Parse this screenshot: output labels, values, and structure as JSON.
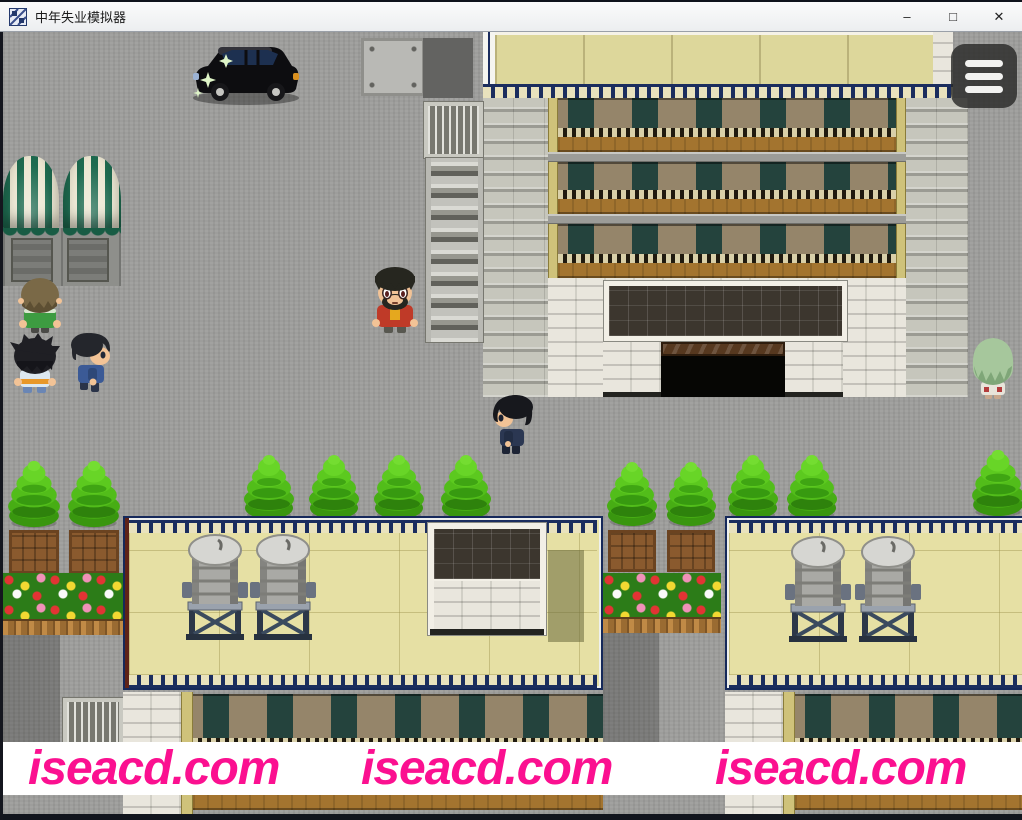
{
  "window": {
    "title": "中年失业模拟器",
    "app_icon": "rpg-maker-window-icon",
    "controls": {
      "minimize": "–",
      "maximize": "□",
      "close": "✕"
    }
  },
  "game": {
    "menu_button": {
      "icon": "hamburger-menu-icon",
      "bar_count": 3
    },
    "watermarks": {
      "left": "iseacd.com",
      "center": "iseacd.com",
      "right": "iseacd.com"
    },
    "palette": {
      "watermark_pink": "#fb1090",
      "pavement_gray": "#9d9d9b",
      "roof_cream": "#e6e0a4",
      "trim_navy": "#1b2d5e",
      "tree_green": "#52bd1a",
      "balcony_brown": "#a3742f",
      "awning_green": "#1e6b50"
    }
  }
}
